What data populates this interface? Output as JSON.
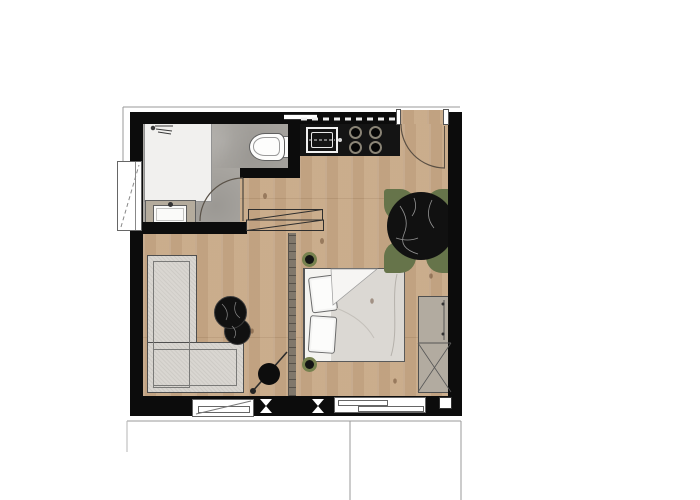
{
  "scene": {
    "type": "architectural floor plan",
    "description": "Top-down colored floor plan of a studio apartment with bathroom, kitchenette, dining, living and sleeping areas plus balcony outline",
    "visible_text": []
  },
  "colors": {
    "wall": "#0c0c0c",
    "wood": "#c9ab8a",
    "bath_floor": "#a8a5a0",
    "shower_tray": "#f1f0ee",
    "fabric": "#d9d6d1",
    "bed_sheet": "#f4f3f0",
    "duvet": "#dbd8d3",
    "vanity": "#b5ac9d",
    "wardrobe": "#b2aba0",
    "chair": "#66744a",
    "plant": "#76814e",
    "marble": "#111111",
    "window": "#ffffff",
    "frame": "#666666",
    "line": "#4f4f4f",
    "hairline": "#9a9a9a",
    "partition": "#80776b"
  },
  "rooms": {
    "bathroom": {
      "label": "bathroom"
    },
    "kitchen": {
      "label": "kitchenette"
    },
    "living": {
      "label": "living area"
    },
    "sleeping": {
      "label": "sleeping area"
    },
    "balcony": {
      "label": "balcony outline"
    }
  },
  "furniture": {
    "shower": {
      "label": "shower tray with shower head"
    },
    "toilet": {
      "label": "wall-hung toilet"
    },
    "vanity": {
      "label": "vanity with washbasin"
    },
    "counter": {
      "label": "kitchen counter"
    },
    "sink": {
      "label": "kitchen sink"
    },
    "cooktop": {
      "label": "4-burner cooktop"
    },
    "sideboard": {
      "label": "low sideboard (outline with diagonals)"
    },
    "table": {
      "label": "round black marble dining table"
    },
    "chair": {
      "label": "olive green dining chair"
    },
    "sofa": {
      "label": "L-shaped sofa"
    },
    "coffee": {
      "label": "set of two round black coffee tables"
    },
    "lamp": {
      "label": "arc floor lamp"
    },
    "bed": {
      "label": "double bed"
    },
    "pillow": {
      "label": "pillow"
    },
    "duvet": {
      "label": "duvet with folded corner"
    },
    "wardrobe": {
      "label": "wardrobe with crossed front"
    },
    "plant": {
      "label": "potted plant"
    },
    "partition": {
      "label": "low partition wall"
    }
  },
  "openings": {
    "entry": {
      "label": "entry door with swing arc"
    },
    "bath_door": {
      "label": "bathroom door with swing arc"
    },
    "window_left": {
      "label": "bathroom window"
    },
    "window_bottom": {
      "label": "living room window"
    },
    "slider": {
      "label": "balcony sliding window"
    },
    "kitchen_window": {
      "label": "kitchen strip window"
    },
    "wall_marker": {
      "label": "wall opening marker (bowtie)"
    }
  }
}
